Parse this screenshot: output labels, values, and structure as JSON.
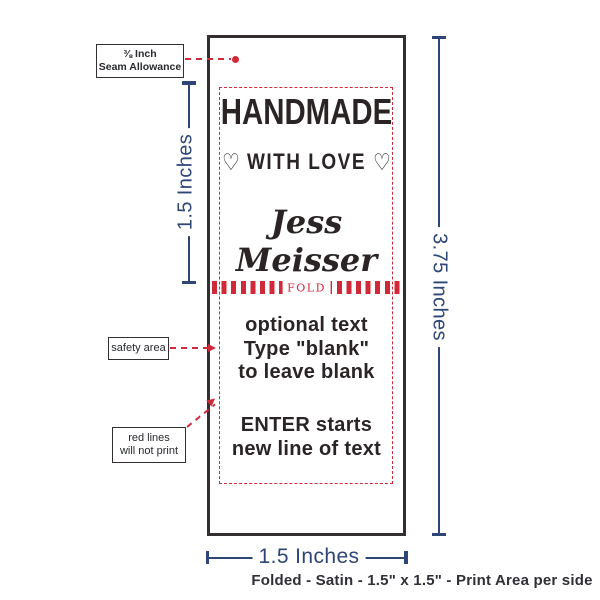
{
  "colors": {
    "navy": "#2d4577",
    "red": "#d0293a",
    "ink": "#27292e",
    "outline_black": "#332f30"
  },
  "label_design": {
    "line1": "HANDMADE",
    "line2": "WITH LOVE",
    "heart": "♡",
    "name": "Jess Meisser",
    "fold": "FOLD",
    "optional_lines": [
      "optional text",
      "Type \"blank\"",
      "to leave blank"
    ],
    "enter_lines": [
      "ENTER starts",
      "new line of text"
    ]
  },
  "annotations": {
    "seam": {
      "line1": "⅜ Inch",
      "line2": "Seam Allowance"
    },
    "safety": "safety area",
    "red_lines": {
      "line1": "red lines",
      "line2": "will not print"
    }
  },
  "dimensions": {
    "left": "1.5 Inches",
    "right": "3.75 Inches",
    "bottom": "1.5 Inches"
  },
  "caption": "Folded - Satin - 1.5\" x 1.5\" - Print Area per side"
}
